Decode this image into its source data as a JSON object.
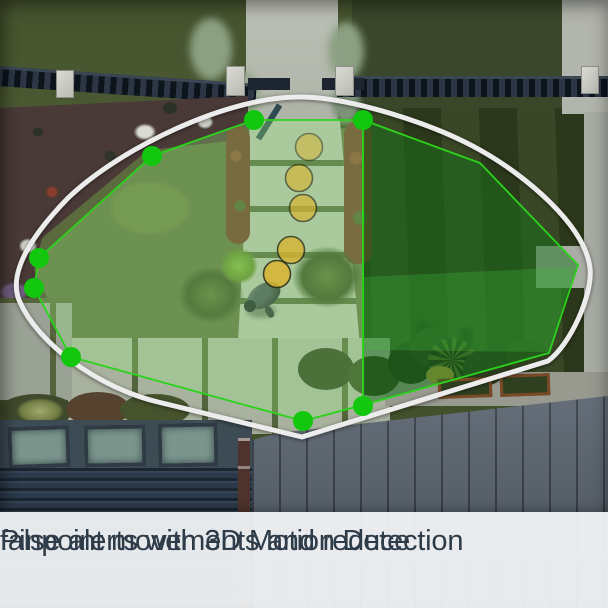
{
  "caption": {
    "line1": "Pinpoint movements and reduce",
    "line2": "false alerts with 3D Motion Detection",
    "text_color": "#2e3b48",
    "background": "rgba(242,244,247,0.94)"
  },
  "overlay": {
    "boundary_stroke": "#ececec",
    "zone_stroke": "#2bd41b",
    "dot_fill": "#12c70d",
    "trail_fill": "#d9b430",
    "trail_stroke": "#2a2a12",
    "light_zone_fill": "rgba(150,235,125,0.30)",
    "dark_zone_fill": "rgba(23,115,28,0.50)",
    "bright_band_fill": "rgba(70,190,60,0.28)",
    "boundary_path": "M303 97 C350 98 430 122 480 150 C525 175 585 225 590 268 C593 295 570 345 548 361 L302 437 L158 402 C100 388 38 345 19 300 C8 272 32 235 68 198 C120 148 230 95 303 97 Z",
    "light_zone_points": "152,156 254,120 363,120 363,405 303,421 71,357 34,288 39,258",
    "dark_zone_points": "363,120 480,163 578,265 549,353 363,405",
    "bright_band_points": "364,277 575,267 549,352 364,350",
    "dot_r": 10,
    "trail_r": 13.5,
    "vertex_dots": [
      [
        152,
        156
      ],
      [
        254,
        120
      ],
      [
        363,
        120
      ],
      [
        363,
        406
      ],
      [
        303,
        421
      ],
      [
        71,
        357
      ],
      [
        34,
        288
      ],
      [
        39,
        258
      ]
    ],
    "trail": [
      [
        309,
        147,
        0.5
      ],
      [
        299,
        178,
        0.62
      ],
      [
        303,
        208,
        0.68
      ],
      [
        291,
        250,
        0.78
      ],
      [
        277,
        274,
        0.85
      ]
    ]
  }
}
